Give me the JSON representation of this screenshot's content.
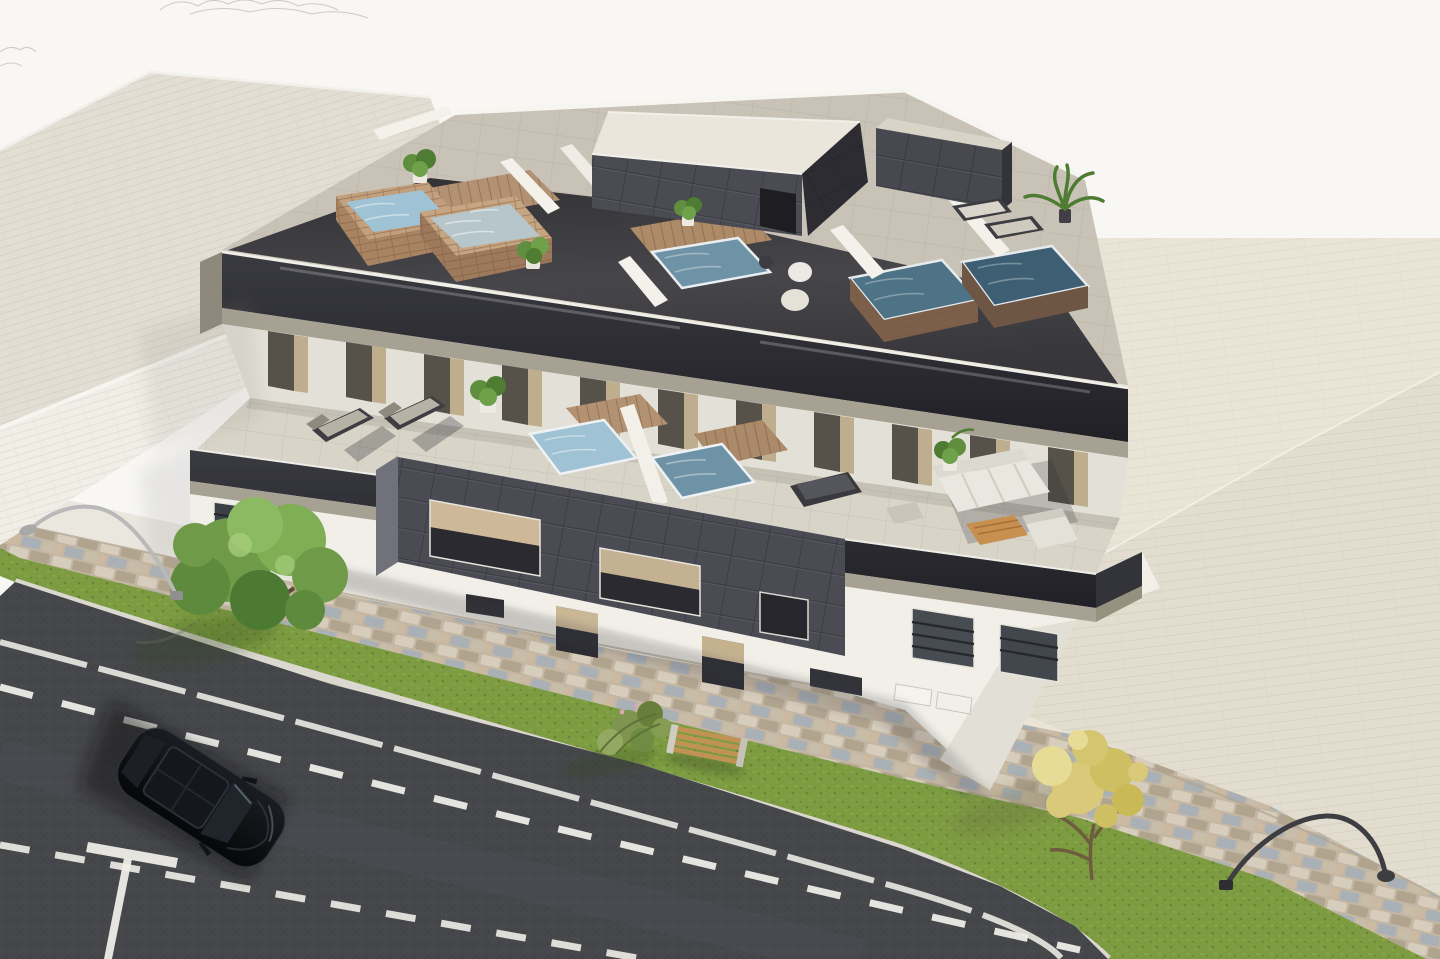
{
  "meta": {
    "type": "3d-architectural-exterior-render",
    "view": "aerial-three-quarter-view",
    "width_px": 1440,
    "height_px": 959
  },
  "scene": {
    "description": "Photorealistic CGI render of a modern two-storey apartment block with a rooftop terrace holding several glass-fenced plunge pools with travertine surrounds, dark tiled stair enclosures and potted plants; a second-floor terrace with sun loungers, two plunge pools and a white outdoor sofa set; white facades with a dark grey tiled feature volume; surrounded by a beige paved plaza, cobblestone pavement, grass verge with a green tree, a yellow tree, a shrub and a wooden bench, two curved street lamps, and an asphalt road with white markings and a parked black car.",
    "objects": [
      "neighbouring flat-roofed building",
      "main apartment building",
      "rooftop terrace",
      "rooftop plunge pools",
      "glass balustrade",
      "stair enclosure with dark tiles",
      "potted plants",
      "palm plant",
      "round poufs",
      "sun loungers",
      "second-floor terrace",
      "terrace plunge pools",
      "timber pool decks",
      "white outdoor sofa",
      "wooden coffee table",
      "outdoor armchair",
      "black recliner",
      "dark tiled feature wall",
      "windows with dark railings",
      "entrance doors",
      "air-conditioning units",
      "paved plaza",
      "cobblestone pavement",
      "sidewalk",
      "grass verge",
      "green tree",
      "yellow tree",
      "shrub",
      "wooden bench",
      "street lamp silver",
      "street lamp dark",
      "asphalt road",
      "kerb",
      "road edge line",
      "dashed centre line",
      "parking bay marking",
      "black car"
    ]
  },
  "palette": {
    "sky": "#f8f7f4",
    "plaza": "#e9e4d6",
    "plaza_dark": "#e2ddcf",
    "sidewalk": "#eae7df",
    "cobble": "#c9bdab",
    "grass": "#7d9c42",
    "road": "#46474b",
    "kerb": "#dbd8d0",
    "marking": "#efede7",
    "neighbor_roof": "#e3ded3",
    "neighbor_wall": "#f0eee7",
    "building_white": "#f1efe8",
    "building_shade": "#e3e0d7",
    "roof_floor": "#c8c3b6",
    "terrace_floor": "#d8d4c8",
    "glass_band": "#2a2a30",
    "parapet_cap": "#a7a193",
    "dark_tile": "#4b4b53",
    "dark_tile_side": "#71717b",
    "pool_light": "#9fc2d4",
    "pool_pale": "#b7c6ca",
    "pool_mid": "#6f93a6",
    "pool_teal": "#4e7386",
    "pool_deep": "#3e5f73",
    "brick": "#c2a07e",
    "brick_shade": "#a88462",
    "wood": "#b29272",
    "plant_green": "#5f8f3e",
    "tree_green": "#6f9b49",
    "tree_yellow": "#d9c979",
    "sofa": "#e9e7e0",
    "table_wood": "#c79050",
    "bench_wood": "#c09355",
    "car_body": "#0e1014",
    "car_glass": "#20252c",
    "lamp_silver": "#b9b9b9",
    "lamp_dark": "#3e3e42"
  }
}
